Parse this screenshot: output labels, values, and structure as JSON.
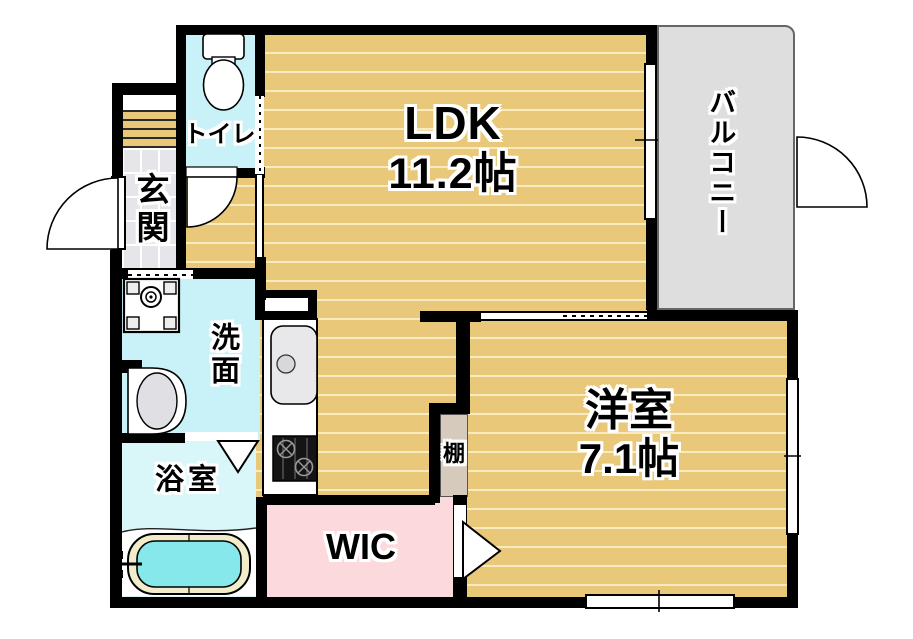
{
  "rooms": {
    "ldk": {
      "name": "LDK",
      "size": "11.2帖"
    },
    "western_room": {
      "name": "洋室",
      "size": "7.1帖"
    },
    "balcony": {
      "name": "バルコニー"
    },
    "toilet": {
      "name": "トイレ"
    },
    "entrance": {
      "name": "玄関"
    },
    "washroom": {
      "name": "洗面"
    },
    "bathroom": {
      "name": "浴室"
    },
    "wic": {
      "name": "WIC"
    },
    "shelf": {
      "name": "棚"
    }
  },
  "colors": {
    "wall": "#000000",
    "wood_floor": "#eac87a",
    "wood_stripe": "#f8ebc0",
    "wet_area_cyan": "#c9f2f8",
    "bath_floor": "#d9f6f9",
    "bath_water": "#86e8ea",
    "tub_rim": "#f1ecca",
    "wic_pink": "#fcd9dd",
    "balcony_gray": "#dedede",
    "entrance_tile": "#e6e6ea",
    "shelf_beige": "#d5cabc"
  },
  "fixtures": [
    "toilet-icon",
    "washing-machine-pan-icon",
    "vanity-sink-icon",
    "kitchen-sink-icon",
    "stove-icon",
    "bathtub-icon",
    "faucet-icon"
  ]
}
